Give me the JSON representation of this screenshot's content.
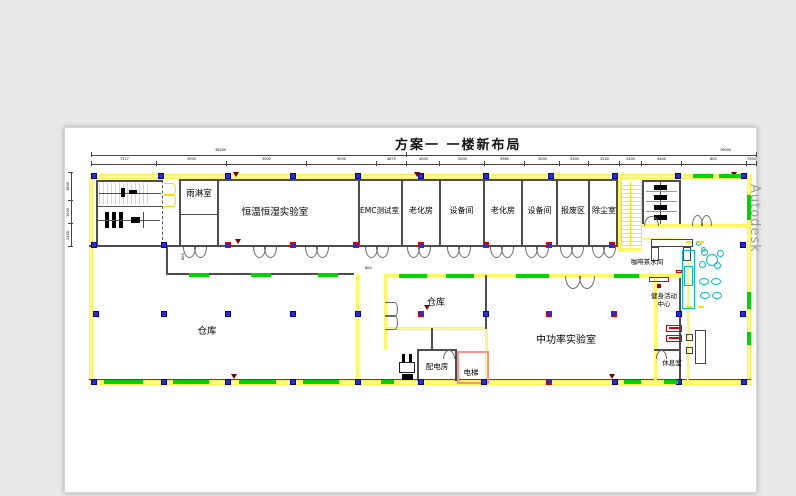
{
  "title": "方案一  一楼新布局",
  "watermark": "Autodesk",
  "rooms": {
    "rain": "雨淋室",
    "humidity_lab": "恒温恒湿实验室",
    "emc_lab": "EMC测试室",
    "aging_room_1": "老化房",
    "equipment_room_1": "设备间",
    "aging_room_2": "老化房",
    "equipment_room_2": "设备间",
    "scrap_area": "报废区",
    "dust_room": "除尘室",
    "warehouse_big": "仓库",
    "warehouse_small": "仓库",
    "mid_power_lab": "中功率实验室",
    "power_dist_room": "配电房",
    "elevator": "电梯",
    "coffee_room": "咖啡茶水间",
    "fitness_center": "健身活动中心",
    "rest_room": "休息室"
  },
  "dims": {
    "top_total": "76000",
    "top_row2": "38200",
    "top_row": [
      "7517",
      "3000",
      "3000",
      "9000",
      "4875",
      "4000",
      "5000",
      "3960",
      "3000",
      "3300",
      "3240",
      "2400",
      "4400",
      "800",
      "7500"
    ],
    "left_col": [
      "1800",
      "1500",
      "2400"
    ],
    "small_h": "800",
    "small_v": "800"
  }
}
